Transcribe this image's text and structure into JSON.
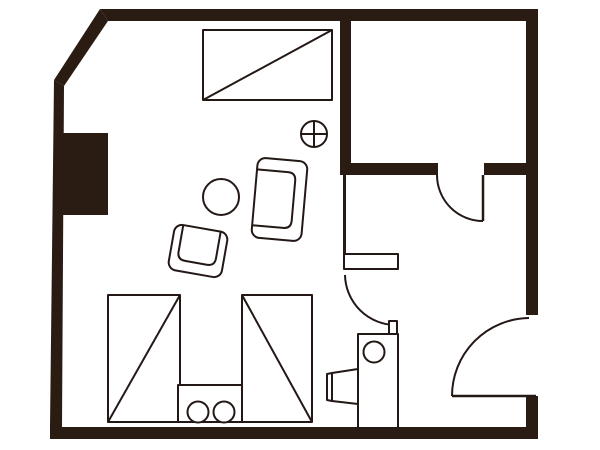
{
  "canvas": {
    "width": 600,
    "height": 450,
    "viewBox": "0 0 600 450",
    "label": "apartment floor plan"
  },
  "style": {
    "wall_color": "#2a1c13",
    "line_color": "#231815",
    "floor_color": "#ffffff",
    "line_width": 2
  },
  "plan": {
    "walls": [
      {
        "name": "top-wall",
        "shapes": [
          {
            "kind": "polygon",
            "points": [
              [
                100,
                9
              ],
              [
                538,
                9
              ],
              [
                538,
                21
              ],
              [
                108,
                21
              ]
            ],
            "fill": "wall"
          }
        ]
      },
      {
        "name": "top-left-chamfer-wall",
        "shapes": [
          {
            "kind": "polygon",
            "points": [
              [
                100,
                9
              ],
              [
                108,
                21
              ],
              [
                64,
                86
              ],
              [
                54,
                80
              ]
            ],
            "fill": "wall"
          }
        ]
      },
      {
        "name": "left-wall",
        "shapes": [
          {
            "kind": "polygon",
            "points": [
              [
                54,
                80
              ],
              [
                64,
                86
              ],
              [
                62,
                427
              ],
              [
                50,
                427
              ]
            ],
            "fill": "wall"
          }
        ]
      },
      {
        "name": "left-pillar",
        "shapes": [
          {
            "kind": "rect",
            "x": 54,
            "y": 133,
            "w": 54,
            "h": 82,
            "fill": "wall"
          }
        ]
      },
      {
        "name": "bottom-wall",
        "shapes": [
          {
            "kind": "rect",
            "x": 50,
            "y": 427,
            "w": 488,
            "h": 12,
            "fill": "wall"
          }
        ]
      },
      {
        "name": "right-wall-upper",
        "shapes": [
          {
            "kind": "rect",
            "x": 526,
            "y": 9,
            "w": 12,
            "h": 306,
            "fill": "wall"
          }
        ]
      },
      {
        "name": "right-wall-lower",
        "shapes": [
          {
            "kind": "rect",
            "x": 526,
            "y": 396,
            "w": 12,
            "h": 43,
            "fill": "wall"
          }
        ]
      },
      {
        "name": "closet-left-wall",
        "shapes": [
          {
            "kind": "rect",
            "x": 340,
            "y": 21,
            "w": 11,
            "h": 154,
            "fill": "wall"
          }
        ]
      },
      {
        "name": "closet-bottom-wall-left",
        "shapes": [
          {
            "kind": "rect",
            "x": 340,
            "y": 163,
            "w": 98,
            "h": 12,
            "fill": "wall"
          }
        ]
      },
      {
        "name": "closet-bottom-wall-right",
        "shapes": [
          {
            "kind": "rect",
            "x": 484,
            "y": 163,
            "w": 42,
            "h": 12,
            "fill": "wall"
          }
        ]
      },
      {
        "name": "hall-partition-wall",
        "shapes": [
          {
            "kind": "rect",
            "x": 343,
            "y": 175,
            "w": 3,
            "h": 80,
            "fill": "wall"
          }
        ]
      }
    ],
    "doors": [
      {
        "name": "closet-door",
        "shapes": [
          {
            "kind": "line",
            "x1": 483,
            "y1": 175,
            "x2": 483,
            "y2": 221,
            "stroke": true,
            "sw": 2.5
          },
          {
            "kind": "path",
            "d": "M437,175 A46,46 0 0 0 483,221",
            "fill": "none",
            "stroke": true
          }
        ]
      },
      {
        "name": "bathroom-door",
        "shapes": [
          {
            "kind": "rect",
            "x": 344,
            "y": 254,
            "w": 54,
            "h": 15,
            "fill": "white",
            "stroke": true
          },
          {
            "kind": "path",
            "d": "M345,275 A51,51 0 0 0 396,325",
            "fill": "none",
            "stroke": true
          },
          {
            "kind": "rect",
            "x": 389,
            "y": 321,
            "w": 8,
            "h": 13,
            "fill": "white",
            "stroke": true
          }
        ]
      },
      {
        "name": "entrance-door",
        "shapes": [
          {
            "kind": "line",
            "x1": 452,
            "y1": 396,
            "x2": 536,
            "y2": 396,
            "stroke": true,
            "sw": 2.5
          },
          {
            "kind": "path",
            "d": "M452,396 A78,78 0 0 1 529,318",
            "fill": "none",
            "stroke": true
          }
        ]
      }
    ],
    "fixtures": [
      {
        "name": "ceiling-light-symbol",
        "shapes": [
          {
            "kind": "circle",
            "cx": 314,
            "cy": 134,
            "r": 13,
            "fill": "white",
            "stroke": true
          },
          {
            "kind": "line",
            "x1": 301,
            "y1": 134,
            "x2": 327,
            "y2": 134,
            "stroke": true
          },
          {
            "kind": "line",
            "x1": 314,
            "y1": 121,
            "x2": 314,
            "y2": 147,
            "stroke": true
          }
        ]
      },
      {
        "name": "washbasin-unit",
        "shapes": [
          {
            "kind": "rect",
            "x": 358,
            "y": 334,
            "w": 40,
            "h": 94,
            "fill": "white",
            "stroke": true
          },
          {
            "kind": "circle",
            "cx": 374,
            "cy": 352,
            "r": 10.5,
            "fill": "white",
            "stroke": true
          }
        ]
      },
      {
        "name": "side-sink",
        "shapes": [
          {
            "kind": "polygon",
            "points": [
              [
                332,
                373
              ],
              [
                358,
                369
              ],
              [
                358,
                404
              ],
              [
                332,
                401
              ]
            ],
            "fill": "white",
            "stroke": true
          },
          {
            "kind": "polygon",
            "points": [
              [
                327,
                374
              ],
              [
                332,
                373
              ],
              [
                332,
                401
              ],
              [
                327,
                400
              ]
            ],
            "fill": "white",
            "stroke": true
          }
        ]
      }
    ],
    "furniture": [
      {
        "name": "desk-with-diagonal",
        "shapes": [
          {
            "kind": "rect",
            "x": 203,
            "y": 30,
            "w": 129,
            "h": 70,
            "fill": "white",
            "stroke": true
          },
          {
            "kind": "line",
            "x1": 203,
            "y1": 100,
            "x2": 332,
            "y2": 30,
            "stroke": true
          }
        ]
      },
      {
        "name": "round-table",
        "shapes": [
          {
            "kind": "circle",
            "cx": 221,
            "cy": 197,
            "r": 18,
            "fill": "white",
            "stroke": true
          }
        ]
      },
      {
        "name": "sofa",
        "transform": "translate(279.5,199.5) rotate(5)",
        "shapes": [
          {
            "kind": "rect",
            "x": -25,
            "y": -40,
            "w": 50,
            "h": 80,
            "rx": 8,
            "fill": "white",
            "stroke": true
          },
          {
            "kind": "path",
            "d": "M-25,-28 L6,-28 Q14,-28 14,-20 L14,20 Q14,28 6,28 L-25,28",
            "fill": "none",
            "stroke": true
          }
        ]
      },
      {
        "name": "armchair",
        "transform": "translate(198,251) rotate(10)",
        "shapes": [
          {
            "kind": "rect",
            "x": -27,
            "y": -23,
            "w": 54,
            "h": 46,
            "rx": 8,
            "fill": "white",
            "stroke": true
          },
          {
            "kind": "path",
            "d": "M-19,-23 L-19,4 Q-19,12 -11,12 L11,12 Q19,12 19,4 L19,-23",
            "fill": "none",
            "stroke": true
          }
        ]
      },
      {
        "name": "wardrobe-left",
        "shapes": [
          {
            "kind": "rect",
            "x": 108,
            "y": 295,
            "w": 72,
            "h": 127,
            "fill": "white",
            "stroke": true
          },
          {
            "kind": "line",
            "x1": 108,
            "y1": 422,
            "x2": 180,
            "y2": 295,
            "stroke": true
          }
        ]
      },
      {
        "name": "wardrobe-right",
        "shapes": [
          {
            "kind": "rect",
            "x": 242,
            "y": 295,
            "w": 70,
            "h": 127,
            "fill": "white",
            "stroke": true
          },
          {
            "kind": "line",
            "x1": 242,
            "y1": 295,
            "x2": 312,
            "y2": 422,
            "stroke": true
          }
        ]
      },
      {
        "name": "counter-with-burners",
        "shapes": [
          {
            "kind": "rect",
            "x": 178,
            "y": 385,
            "w": 64,
            "h": 37,
            "fill": "white",
            "stroke": true
          },
          {
            "kind": "circle",
            "cx": 198,
            "cy": 412,
            "r": 10.5,
            "fill": "white",
            "stroke": true
          },
          {
            "kind": "circle",
            "cx": 224,
            "cy": 412,
            "r": 10.5,
            "fill": "white",
            "stroke": true
          }
        ]
      }
    ]
  }
}
